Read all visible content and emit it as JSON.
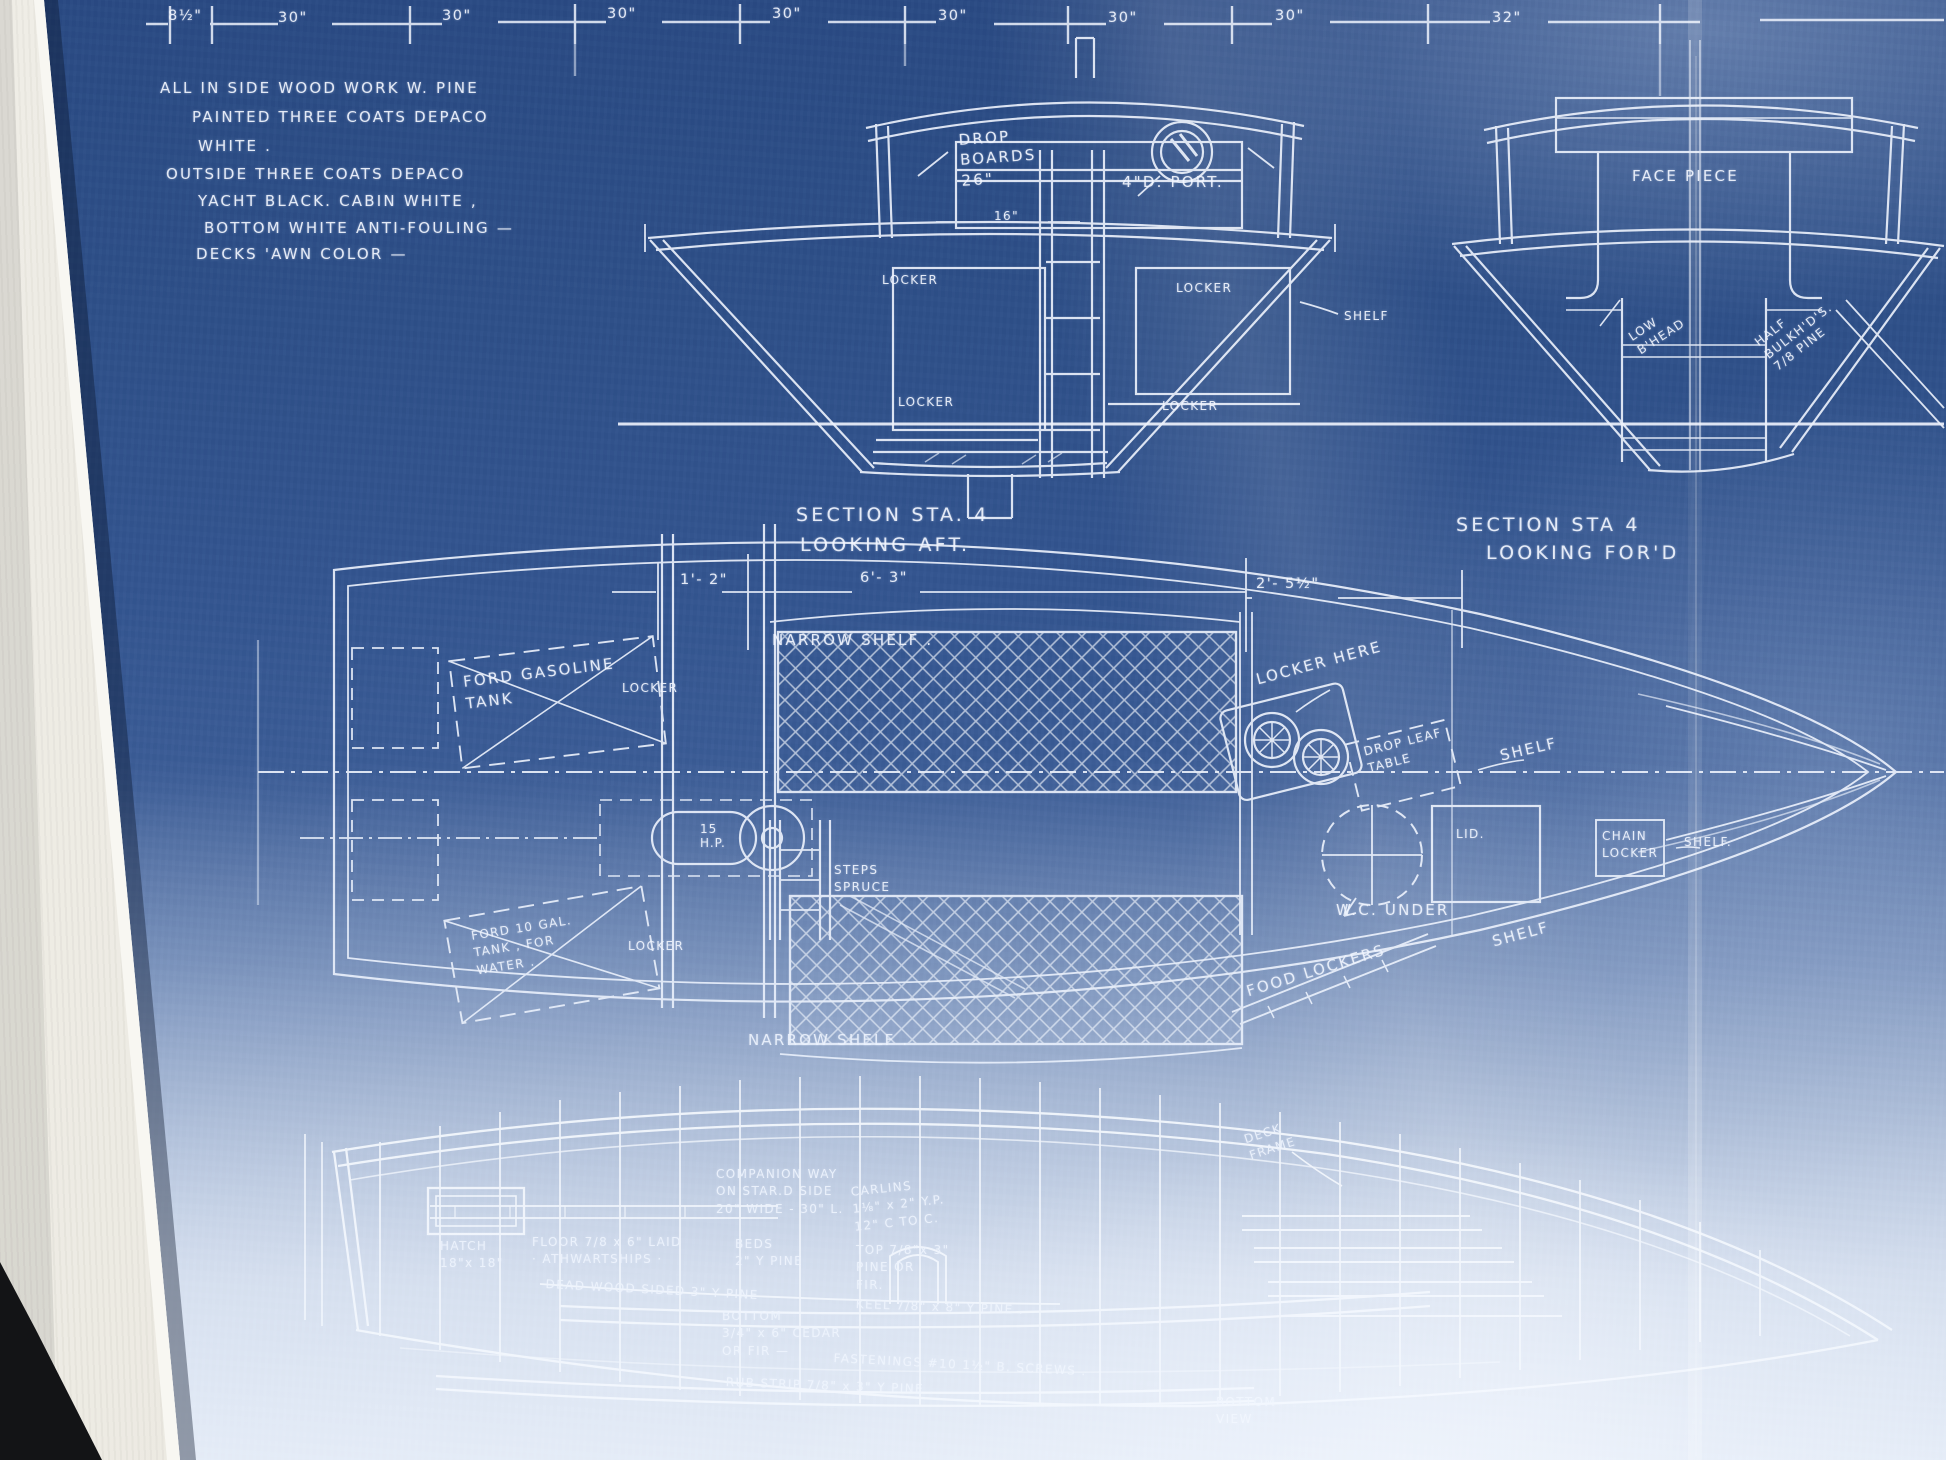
{
  "photo": {
    "description": "Framed cyanotype boat blueprint behind glass",
    "colors": {
      "blueprint_blue": "#335590",
      "washed_blue": "#c8d3e6",
      "line_white": "#f2f6ff",
      "mat_white": "#efede6",
      "corner_dark": "#131416"
    }
  },
  "top_dimensions": {
    "labels": [
      "8½\"",
      "30\"",
      "30\"",
      "30\"",
      "30\"",
      "30\"",
      "30\"",
      "30\"",
      "32\""
    ]
  },
  "notes": {
    "lines": [
      "ALL IN SIDE  WOOD WORK   W. PINE",
      "PAINTED  THREE  COATS  DEPACO",
      "WHITE .",
      "OUTSIDE  THREE  COATS  DEPACO",
      "YACHT  BLACK.   CABIN  WHITE ,",
      "BOTTOM  WHITE  ANTI-FOULING  —",
      "DECKS   'AWN  COLOR  —"
    ]
  },
  "section_aft": {
    "drop_boards": "DROP\nBOARDS\n26\"",
    "port": "4\"D. PORT.",
    "dim_16": "16\"",
    "locker_upper_left": "LOCKER",
    "locker_upper_right": "LOCKER",
    "shelf": "SHELF",
    "locker_lower_left": "LOCKER",
    "locker_lower_right": "LOCKER",
    "caption_line1": "SECTION  STA. 4",
    "caption_line2": "LOOKING  AFT."
  },
  "section_fwd": {
    "face_piece": "FACE PIECE",
    "low_bulkhead": "LOW\nB'HEAD",
    "half_bulkheads": "HALF\nBULKH'D'S.\n7/8 PINE",
    "caption_line1": "SECTION  STA  4",
    "caption_line2": "LOOKING  FOR'D"
  },
  "plan": {
    "dim_left": "1'- 2\"",
    "dim_mid": "6'- 3\"",
    "dim_right": "2'- 5½\"",
    "narrow_shelf_top": "NARROW  SHELF .",
    "ford_gasoline_tank": "FORD  GASOLINE\nTANK",
    "locker_top": "LOCKER",
    "locker_here": "LOCKER  HERE",
    "drop_leaf_table": "DROP LEAF\nTABLE",
    "shelf_upper_right": "SHELF",
    "lid": "LID.",
    "chain_locker": "CHAIN\nLOCKER",
    "shelf_far_right": "SHELF.",
    "wc_under": "W.C. UNDER",
    "engine": "15\nH.P.",
    "steps": "STEPS\nSPRUCE",
    "water_tank": "FORD  10 GAL.\nTANK , FOR\nWATER .",
    "locker_bottom": "LOCKER",
    "food_lockers": "FOOD LOCKERS",
    "shelf_lower_right": "SHELF",
    "narrow_shelf_bottom": "NARROW  SHELF ."
  },
  "profile": {
    "deck_frame": "DECK\nFRAME",
    "companion_way": "COMPANION WAY\nON STAR.D SIDE\n20\" WIDE - 30\" L.",
    "carlins": "CARLINS\n1⅛\" x 2\"  Y.P.\n12\" C TO C.",
    "hatch": "HATCH\n18\"x 18\"",
    "floor": "FLOOR 7/8 x 6\"  LAID\n· ATHWARTSHIPS ·",
    "beds": "BEDS\n2\" Y PINE",
    "top_planking": "TOP  7/8\"x 3\"\nPINE OR\nFIR.",
    "dead_wood": "DEAD  WOOD  SIDED   3\"  Y PINE",
    "keel": "KEEL   7/8\" x 8\"   Y PINE .",
    "bottom_planking": "BOTTOM\n3/4\" x 6\"  CEDAR\nOR FIR  —",
    "fastenings": "FASTENINGS  #10  1½\"  B. SCREWS .",
    "rub_strip": "RUB   STRIP   7/8\" x 3\"   Y PINE .",
    "bottom_view": "BOTTOM\nVIEW"
  }
}
